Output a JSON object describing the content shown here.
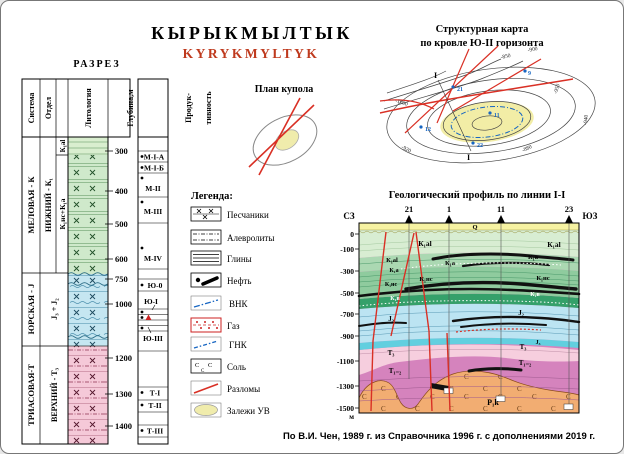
{
  "titles": {
    "main": "КЫРЫКМЫЛТЫК",
    "latin": "KYRYKMYLTYK",
    "razrez": "РАЗРЕЗ",
    "dome": "План купола",
    "map1": "Структурная карта",
    "map2": "по кровле Ю-II горизонта",
    "legend": "Легенда:",
    "profile": "Геологический профиль по линии I-I",
    "source": "По В.И. Чен, 1989 г. из Справочника 1996 г. с дополнениями 2019 г."
  },
  "colors": {
    "title_red": "#bf3a1e",
    "fault_red": "#d93025",
    "deposit_yellow": "#f2eda6",
    "contact_blue": "#1766c2"
  },
  "column": {
    "headers": [
      "Система",
      "Отдел",
      "Ярус",
      "Литология",
      "Глубина,м"
    ],
    "prod_header": [
      "Продук-",
      "тивность"
    ],
    "eras": [
      {
        "system": "МЕЛОВАЯ - К",
        "otdel": "НИЖНИЙ - К₁",
        "yarus_top": "К₁al",
        "yarus": "К₁нс+К₁а"
      },
      {
        "system": "ЮРСКАЯ - J",
        "otdel": "J₃ + J₂"
      },
      {
        "system": "ТРИАСОВАЯ-Т",
        "otdel": "ВЕРХНИЙ - Т₃"
      }
    ],
    "depths": [
      "300",
      "400",
      "500",
      "600",
      "750",
      "1000",
      "1200",
      "1300",
      "1400"
    ],
    "productivity": [
      "М-I-А",
      "М-I-Б",
      "М-II",
      "М-III",
      "М-IV",
      "Ю-0",
      "Ю-I",
      "Ю-III",
      "Т-I",
      "Т-II",
      "Т-III"
    ]
  },
  "legend": {
    "items": [
      {
        "label": "Песчаники"
      },
      {
        "label": "Алевролиты"
      },
      {
        "label": "Глины"
      },
      {
        "label": "Нефть"
      },
      {
        "label": "ВНК"
      },
      {
        "label": "Газ"
      },
      {
        "label": "ГНК"
      },
      {
        "label": "Соль"
      },
      {
        "label": "Разломы"
      },
      {
        "label": "Залежи УВ"
      }
    ]
  },
  "map": {
    "wells": [
      "21",
      "9",
      "11",
      "12",
      "22"
    ],
    "marks": [
      "I",
      "I"
    ],
    "contours": [
      "-850",
      "-900",
      "-950",
      "-1000",
      "-880",
      "-920",
      "-940"
    ]
  },
  "profile": {
    "dir_left": "СЗ",
    "dir_right": "ЮЗ",
    "wells": [
      "21",
      "1",
      "11",
      "23"
    ],
    "depths": [
      "0",
      "-100",
      "-300",
      "-500",
      "-700",
      "-900",
      "-1100",
      "-1300",
      "-1500"
    ],
    "unit": "м",
    "labels": {
      "q": "Q",
      "k1al": "К₁al",
      "k1a": "К₁а",
      "k1nc": "К₁нс",
      "k1v": "К₁в",
      "j2": "J₂",
      "j3": "J₃",
      "t3": "Т₃",
      "t12": "Т₁₋₂",
      "p1k": "Р₁k",
      "salt": "С"
    }
  }
}
